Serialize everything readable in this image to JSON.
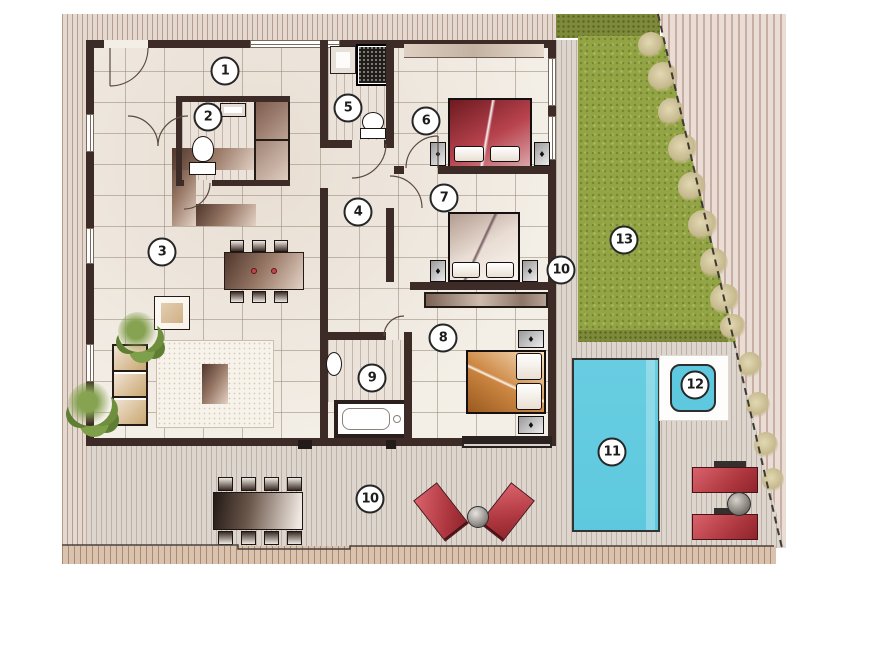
{
  "markers": [
    {
      "id": "room-1",
      "label": "1",
      "x": 225,
      "y": 71
    },
    {
      "id": "room-2",
      "label": "2",
      "x": 208,
      "y": 117
    },
    {
      "id": "room-3",
      "label": "3",
      "x": 162,
      "y": 252
    },
    {
      "id": "room-4",
      "label": "4",
      "x": 358,
      "y": 212
    },
    {
      "id": "room-5",
      "label": "5",
      "x": 348,
      "y": 108
    },
    {
      "id": "room-6",
      "label": "6",
      "x": 426,
      "y": 121
    },
    {
      "id": "room-7",
      "label": "7",
      "x": 444,
      "y": 198
    },
    {
      "id": "room-8",
      "label": "8",
      "x": 443,
      "y": 338
    },
    {
      "id": "room-9",
      "label": "9",
      "x": 372,
      "y": 378
    },
    {
      "id": "room-10a",
      "label": "10",
      "x": 561,
      "y": 270
    },
    {
      "id": "room-10b",
      "label": "10",
      "x": 370,
      "y": 499
    },
    {
      "id": "room-11",
      "label": "11",
      "x": 612,
      "y": 452
    },
    {
      "id": "room-12",
      "label": "12",
      "x": 695,
      "y": 385
    },
    {
      "id": "room-13",
      "label": "13",
      "x": 624,
      "y": 240
    }
  ],
  "glyphs": {
    "lamp": "♦"
  },
  "colors": {
    "wall": "#3c2b27",
    "tile": "#f3eee6",
    "walk_light": "#e5d8cf",
    "walk_stripe": "#b49c8e",
    "deck_light": "#ddd6cf",
    "deck_stripe": "#bfb0a6",
    "sand_light": "#d9c2ae",
    "sand_stripe": "#aa8a72",
    "lawn": "#93a444",
    "hedge": "#7e8a3a",
    "pool": "#5ec9de",
    "accent_red": "#c3454e",
    "marker_border": "#262626"
  }
}
